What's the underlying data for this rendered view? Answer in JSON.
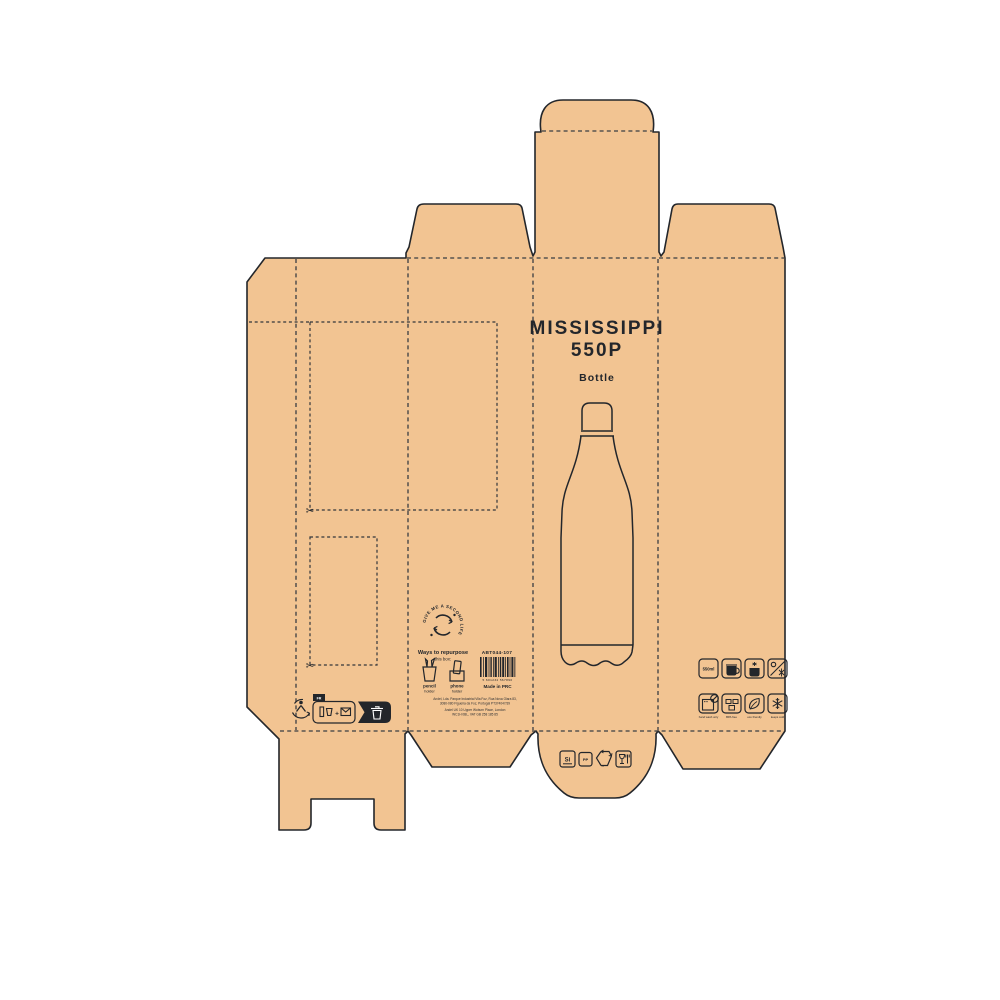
{
  "product": {
    "title_line1": "MISSISSIPPI",
    "title_line2": "550P",
    "subtitle": "Bottle"
  },
  "repurpose": {
    "stamp_text": "GIVE ME A SECOND LIFE",
    "heading": "Ways to repurpose",
    "subheading": "this box:",
    "options": [
      {
        "top": "pencil",
        "bottom": "holder"
      },
      {
        "top": "phone",
        "bottom": "holder"
      }
    ]
  },
  "sku": "ABT044-107",
  "barcode_digits": "5 601234 567890",
  "made_in": "Made in PRC",
  "company": {
    "line1": "Andel, Lda. Parque Industrial Vila Foz, Rua Nova Olara 83,",
    "line2": "3080-080 Figueira da Foz, Portugal PT374047/39",
    "line3": "Andel UK 10 Upper Woburn Place, London",
    "line4": "WC1H 0BL, VAT GB 258 185 85"
  },
  "recycling": {
    "country_tab": "FR",
    "plus": "+"
  },
  "capacity_label": "550ml",
  "feature_labels": [
    "hand wash only",
    "BPA free",
    "eco friendly",
    "keeps cold"
  ],
  "materials": {
    "silicone": "Si",
    "plastic": "PP"
  },
  "colors": {
    "kraft": "#f2c492",
    "line": "#23262b",
    "fold_line": "#3a3d42",
    "background": "#ffffff"
  }
}
